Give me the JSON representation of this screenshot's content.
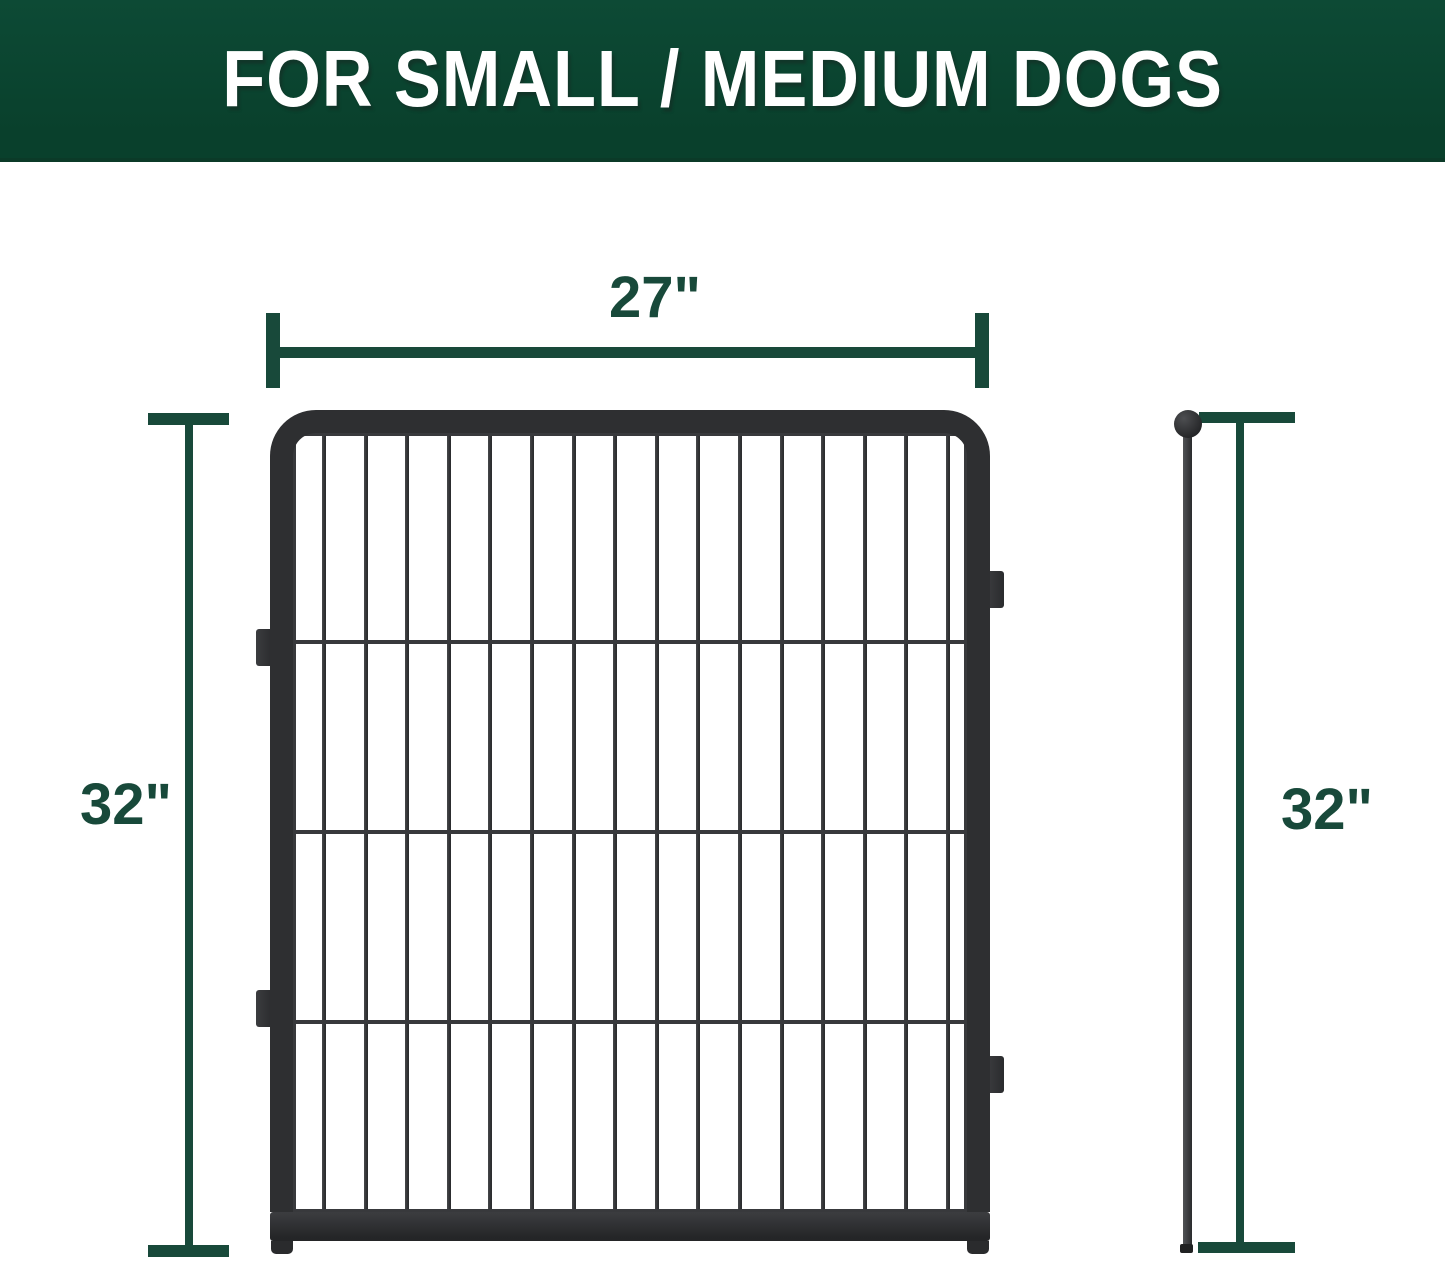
{
  "banner": {
    "title": "FOR SMALL / MEDIUM DOGS"
  },
  "annotations": {
    "width": "27\"",
    "height_front": "32\"",
    "height_side": "32\""
  },
  "colors": {
    "banner_green": "#09402c",
    "banner_green_light": "#0d4a35",
    "banner_edge": "#0b3a28",
    "dimension_green": "#18493a",
    "frame_dark": "#2e2f31",
    "wire_dark": "#38393c"
  },
  "panel": {
    "vertical_bars": 16,
    "mesh_rows": 4,
    "horizontal_wires_pct": [
      26.4,
      51.0,
      75.5
    ],
    "connector_tabs": [
      {
        "side": "left",
        "top": 629
      },
      {
        "side": "left",
        "top": 990
      },
      {
        "side": "right",
        "top": 571
      },
      {
        "side": "right",
        "top": 1056
      }
    ]
  }
}
